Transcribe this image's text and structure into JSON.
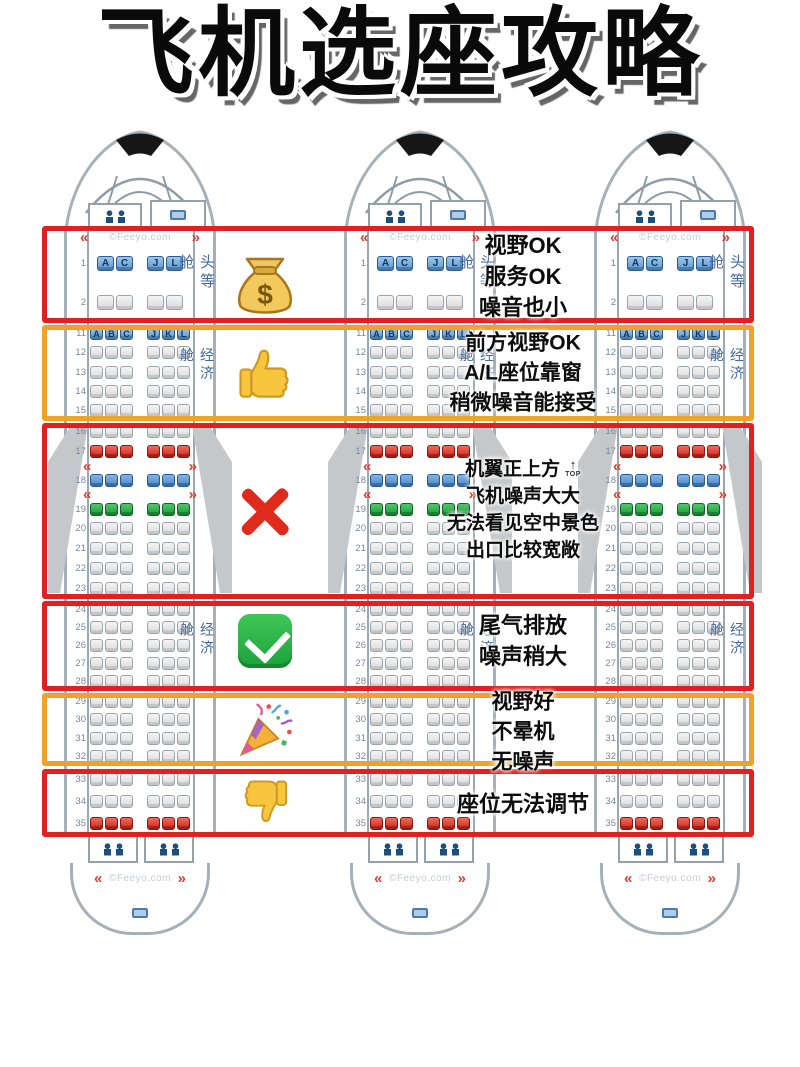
{
  "title": "飞机选座攻略",
  "watermark": "©Feeyo.com",
  "plane": {
    "top_marker": "TOP",
    "fc_letters": [
      [
        "A",
        "C"
      ],
      [
        "J",
        "L"
      ]
    ],
    "eco_letters": [
      [
        "A",
        "B",
        "C"
      ],
      [
        "J",
        "K",
        "L"
      ]
    ]
  },
  "sections": [
    {
      "id": "first-class",
      "cabin_label": "头等舱",
      "rows": [
        {
          "n": "1",
          "type": "fc-letters"
        },
        {
          "n": "2",
          "type": "fc"
        }
      ]
    },
    {
      "id": "economy-front",
      "cabin_label": "经济舱",
      "rows": [
        {
          "n": "11",
          "type": "letters"
        },
        {
          "n": "12"
        },
        {
          "n": "13"
        },
        {
          "n": "14"
        },
        {
          "n": "15"
        }
      ]
    },
    {
      "id": "over-wing",
      "rows": [
        {
          "n": "16"
        },
        {
          "n": "17",
          "color": "red"
        },
        {
          "n": "18",
          "color": "blue",
          "exit_before": true
        },
        {
          "n": "19",
          "color": "green",
          "exit_before": true
        },
        {
          "n": "20"
        },
        {
          "n": "21"
        },
        {
          "n": "22"
        },
        {
          "n": "23"
        }
      ]
    },
    {
      "id": "economy-mid",
      "cabin_label": "经济舱",
      "rows": [
        {
          "n": "24"
        },
        {
          "n": "25"
        },
        {
          "n": "26"
        },
        {
          "n": "27"
        },
        {
          "n": "28"
        }
      ]
    },
    {
      "id": "economy-rear",
      "rows": [
        {
          "n": "29"
        },
        {
          "n": "30"
        },
        {
          "n": "31"
        },
        {
          "n": "32"
        }
      ]
    },
    {
      "id": "last-rows",
      "rows": [
        {
          "n": "33"
        },
        {
          "n": "34"
        },
        {
          "n": "35",
          "color": "red"
        }
      ]
    }
  ],
  "zones": [
    {
      "id": "first-class",
      "box": "red",
      "emoji": "money-bag",
      "lines": [
        "视野OK",
        "服务OK",
        "噪音也小"
      ]
    },
    {
      "id": "economy-front",
      "box": "orange",
      "emoji": "thumbs-up",
      "lines": [
        "前方视野OK",
        "A/L座位靠窗",
        "稍微噪音能接受"
      ]
    },
    {
      "id": "over-wing",
      "box": "red",
      "emoji": "cross-mark",
      "lines": [
        "机翼正上方",
        "飞机噪声大大",
        "无法看见空中景色",
        "出口比较宽敞"
      ]
    },
    {
      "id": "rear-engine",
      "box": "red",
      "emoji": "check-mark",
      "lines": [
        "尾气排放",
        "噪声稍大"
      ]
    },
    {
      "id": "rear-view",
      "box": "orange",
      "emoji": "party-popper",
      "lines": [
        "视野好",
        "不晕机",
        "无噪声"
      ]
    },
    {
      "id": "last-rows",
      "box": "red",
      "emoji": "thumbs-down",
      "lines": [
        "座位无法调节"
      ]
    }
  ],
  "colors": {
    "box_red": "#e41f1f",
    "box_orange": "#efa227",
    "seat_gray": "#e4e4e4",
    "seat_red": "#cd2417",
    "seat_blue": "#4c88c6",
    "seat_green": "#199e36",
    "seat_letter_blue": "#5e97cc",
    "hull_gray": "#a5b1ba",
    "wing_gray": "#c5c8ca",
    "row_number": "#76879f",
    "cabin_label": "#44699f",
    "exit_chevron": "#e03a2e",
    "watermark": "#c6ccd4"
  }
}
